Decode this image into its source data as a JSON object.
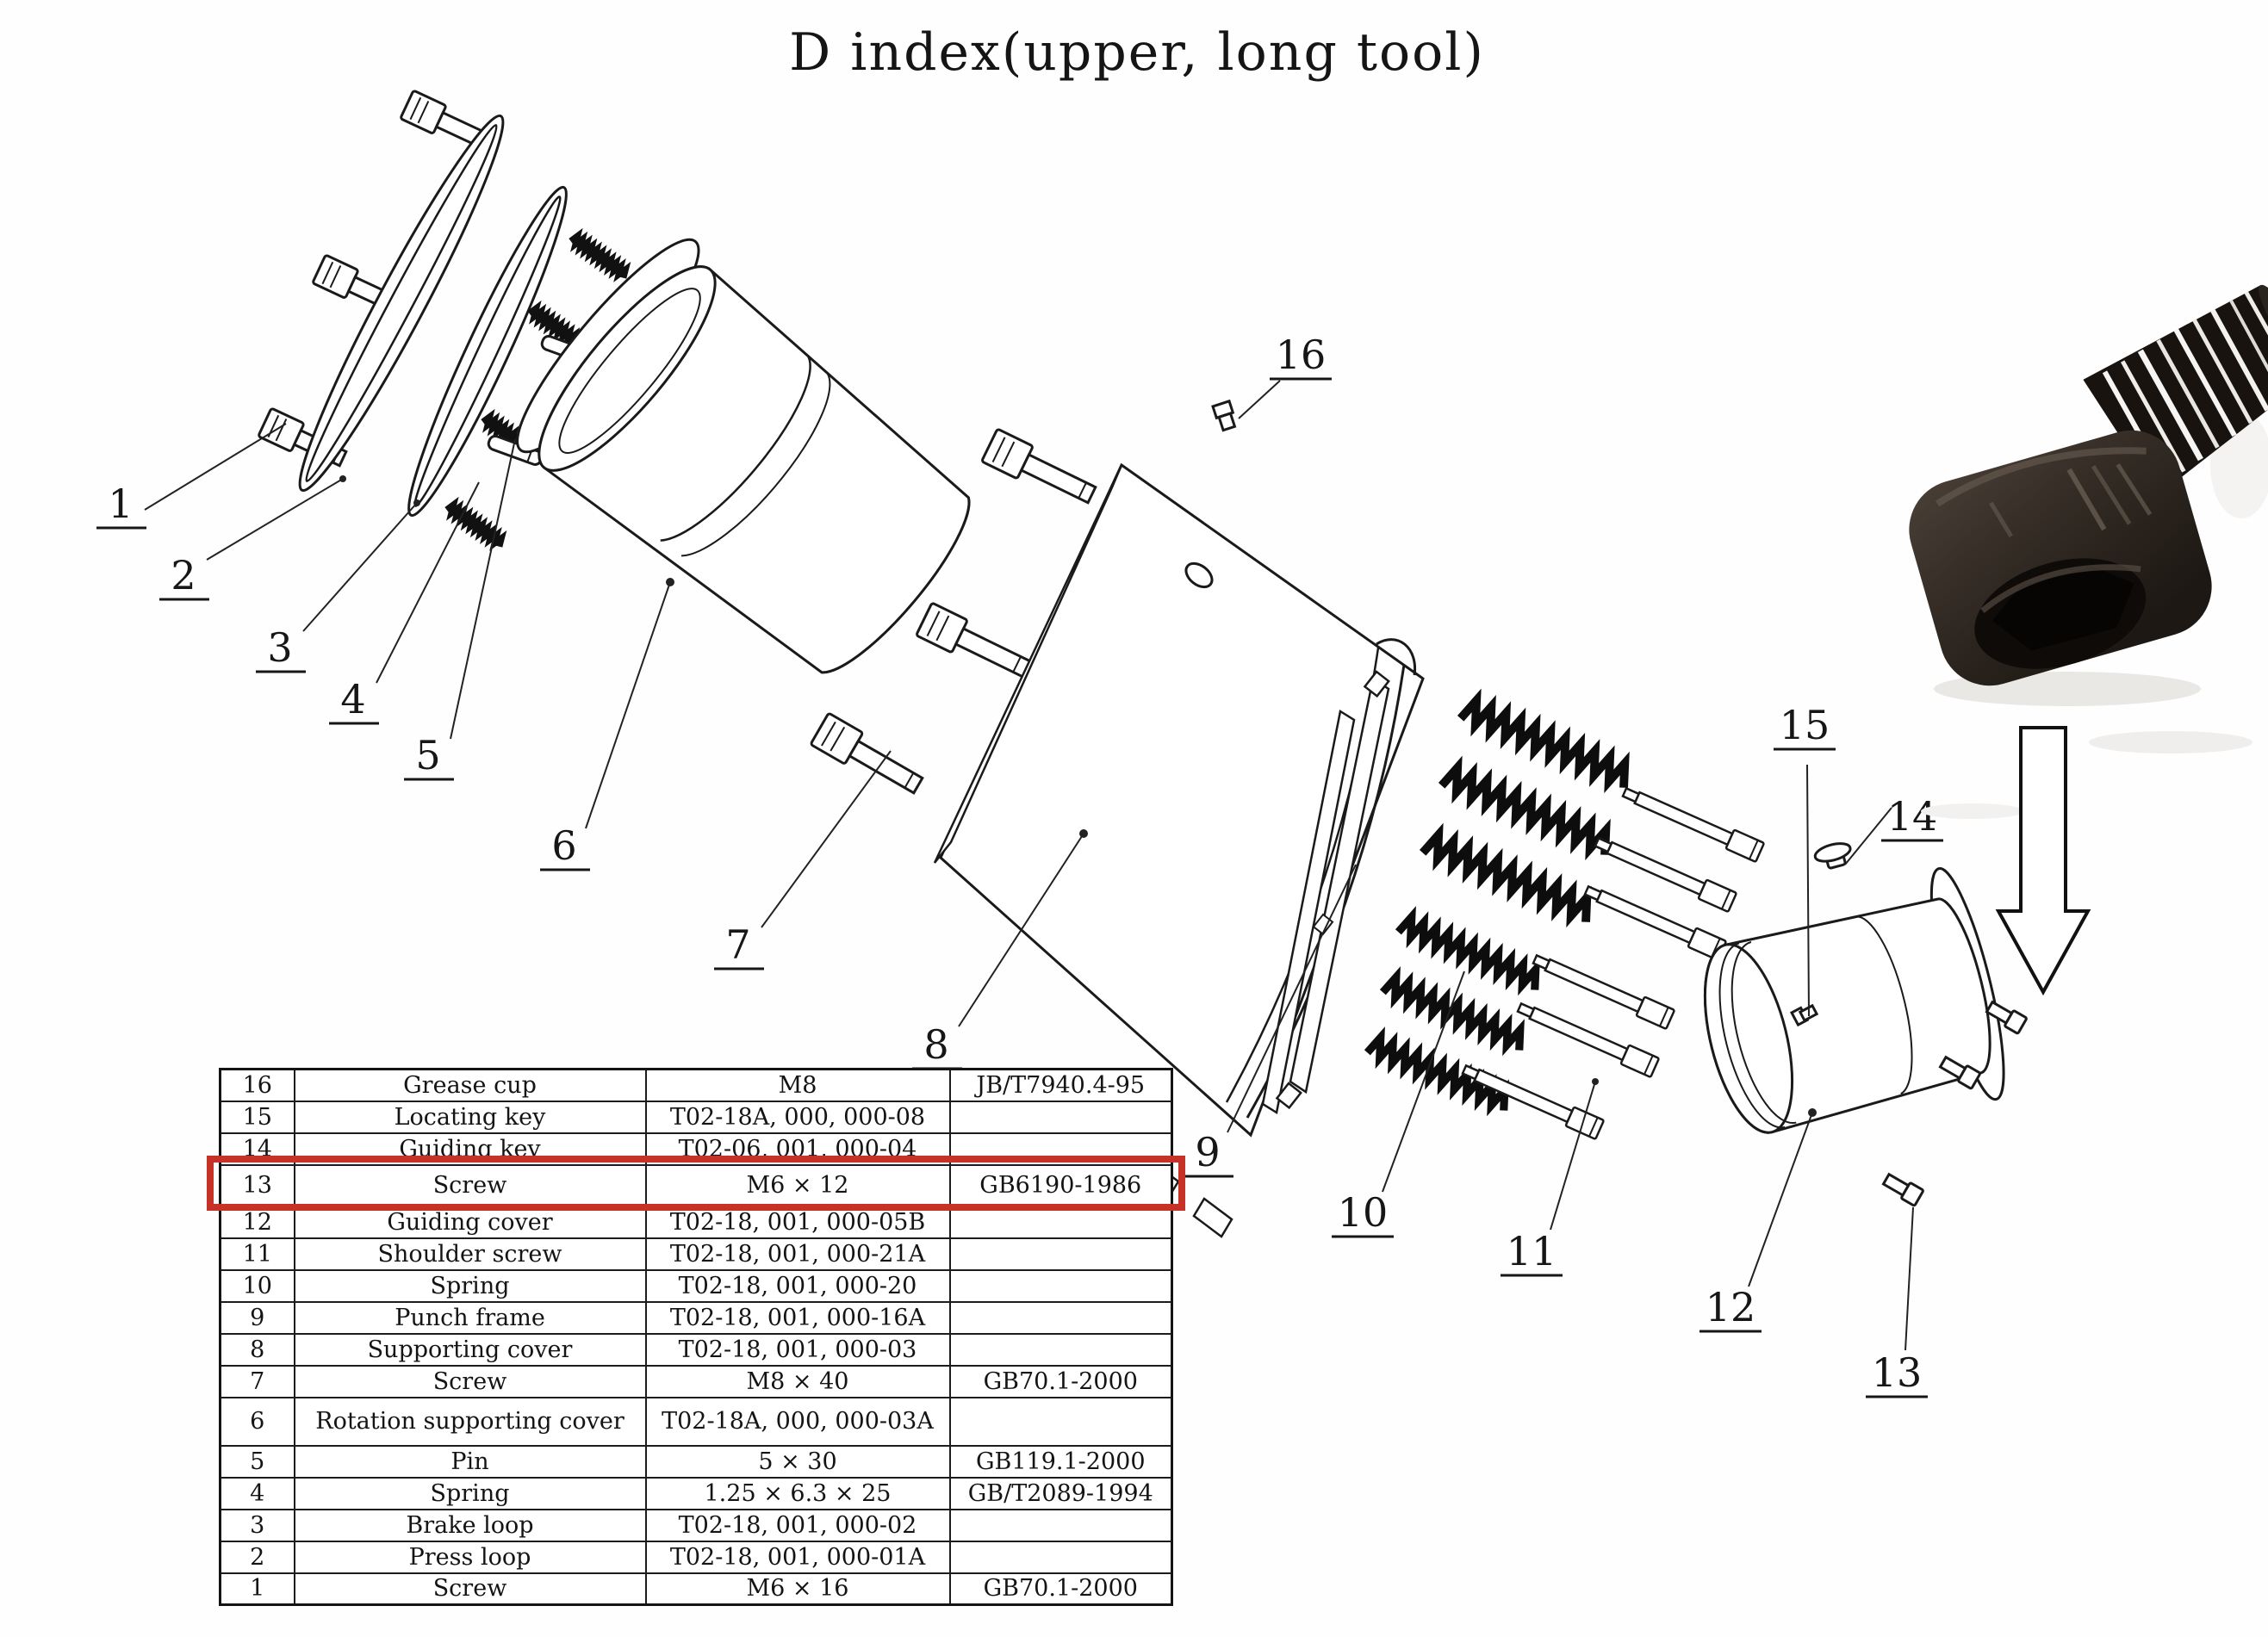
{
  "title": "D index(upper, long tool)",
  "colors": {
    "accent_red": "#c63326",
    "ink": "#1a1a1a"
  },
  "diagram": {
    "callouts": [
      "1",
      "2",
      "3",
      "4",
      "5",
      "6",
      "7",
      "8",
      "9",
      "10",
      "11",
      "12",
      "13",
      "14",
      "15",
      "16"
    ],
    "highlighted_part": "13",
    "inset": {
      "photo": "socket-head-cap-screw",
      "pointer": "down-arrow"
    }
  },
  "table": {
    "columns": [
      "No.",
      "Part name",
      "Specification / Drawing No.",
      "Standard"
    ],
    "rows": [
      {
        "no": "16",
        "name": "Grease cup",
        "spec": "M8",
        "standard": "JB/T7940.4-95"
      },
      {
        "no": "15",
        "name": "Locating key",
        "spec": "T02-18A, 000, 000-08",
        "standard": ""
      },
      {
        "no": "14",
        "name": "Guiding key",
        "spec": "T02-06, 001, 000-04",
        "standard": ""
      },
      {
        "no": "13",
        "name": "Screw",
        "spec": "M6 × 12",
        "standard": "GB6190-1986"
      },
      {
        "no": "12",
        "name": "Guiding cover",
        "spec": "T02-18, 001, 000-05B",
        "standard": ""
      },
      {
        "no": "11",
        "name": "Shoulder screw",
        "spec": "T02-18, 001, 000-21A",
        "standard": ""
      },
      {
        "no": "10",
        "name": "Spring",
        "spec": "T02-18, 001, 000-20",
        "standard": ""
      },
      {
        "no": "9",
        "name": "Punch frame",
        "spec": "T02-18, 001, 000-16A",
        "standard": ""
      },
      {
        "no": "8",
        "name": "Supporting cover",
        "spec": "T02-18, 001, 000-03",
        "standard": ""
      },
      {
        "no": "7",
        "name": "Screw",
        "spec": "M8 × 40",
        "standard": "GB70.1-2000"
      },
      {
        "no": "6",
        "name": "Rotation supporting cover",
        "spec": "T02-18A, 000, 000-03A",
        "standard": ""
      },
      {
        "no": "5",
        "name": "Pin",
        "spec": "5 × 30",
        "standard": "GB119.1-2000"
      },
      {
        "no": "4",
        "name": "Spring",
        "spec": "1.25 × 6.3 × 25",
        "standard": "GB/T2089-1994"
      },
      {
        "no": "3",
        "name": "Brake loop",
        "spec": "T02-18, 001, 000-02",
        "standard": ""
      },
      {
        "no": "2",
        "name": "Press loop",
        "spec": "T02-18, 001, 000-01A",
        "standard": ""
      },
      {
        "no": "1",
        "name": "Screw",
        "spec": "M6 × 16",
        "standard": "GB70.1-2000"
      }
    ]
  }
}
